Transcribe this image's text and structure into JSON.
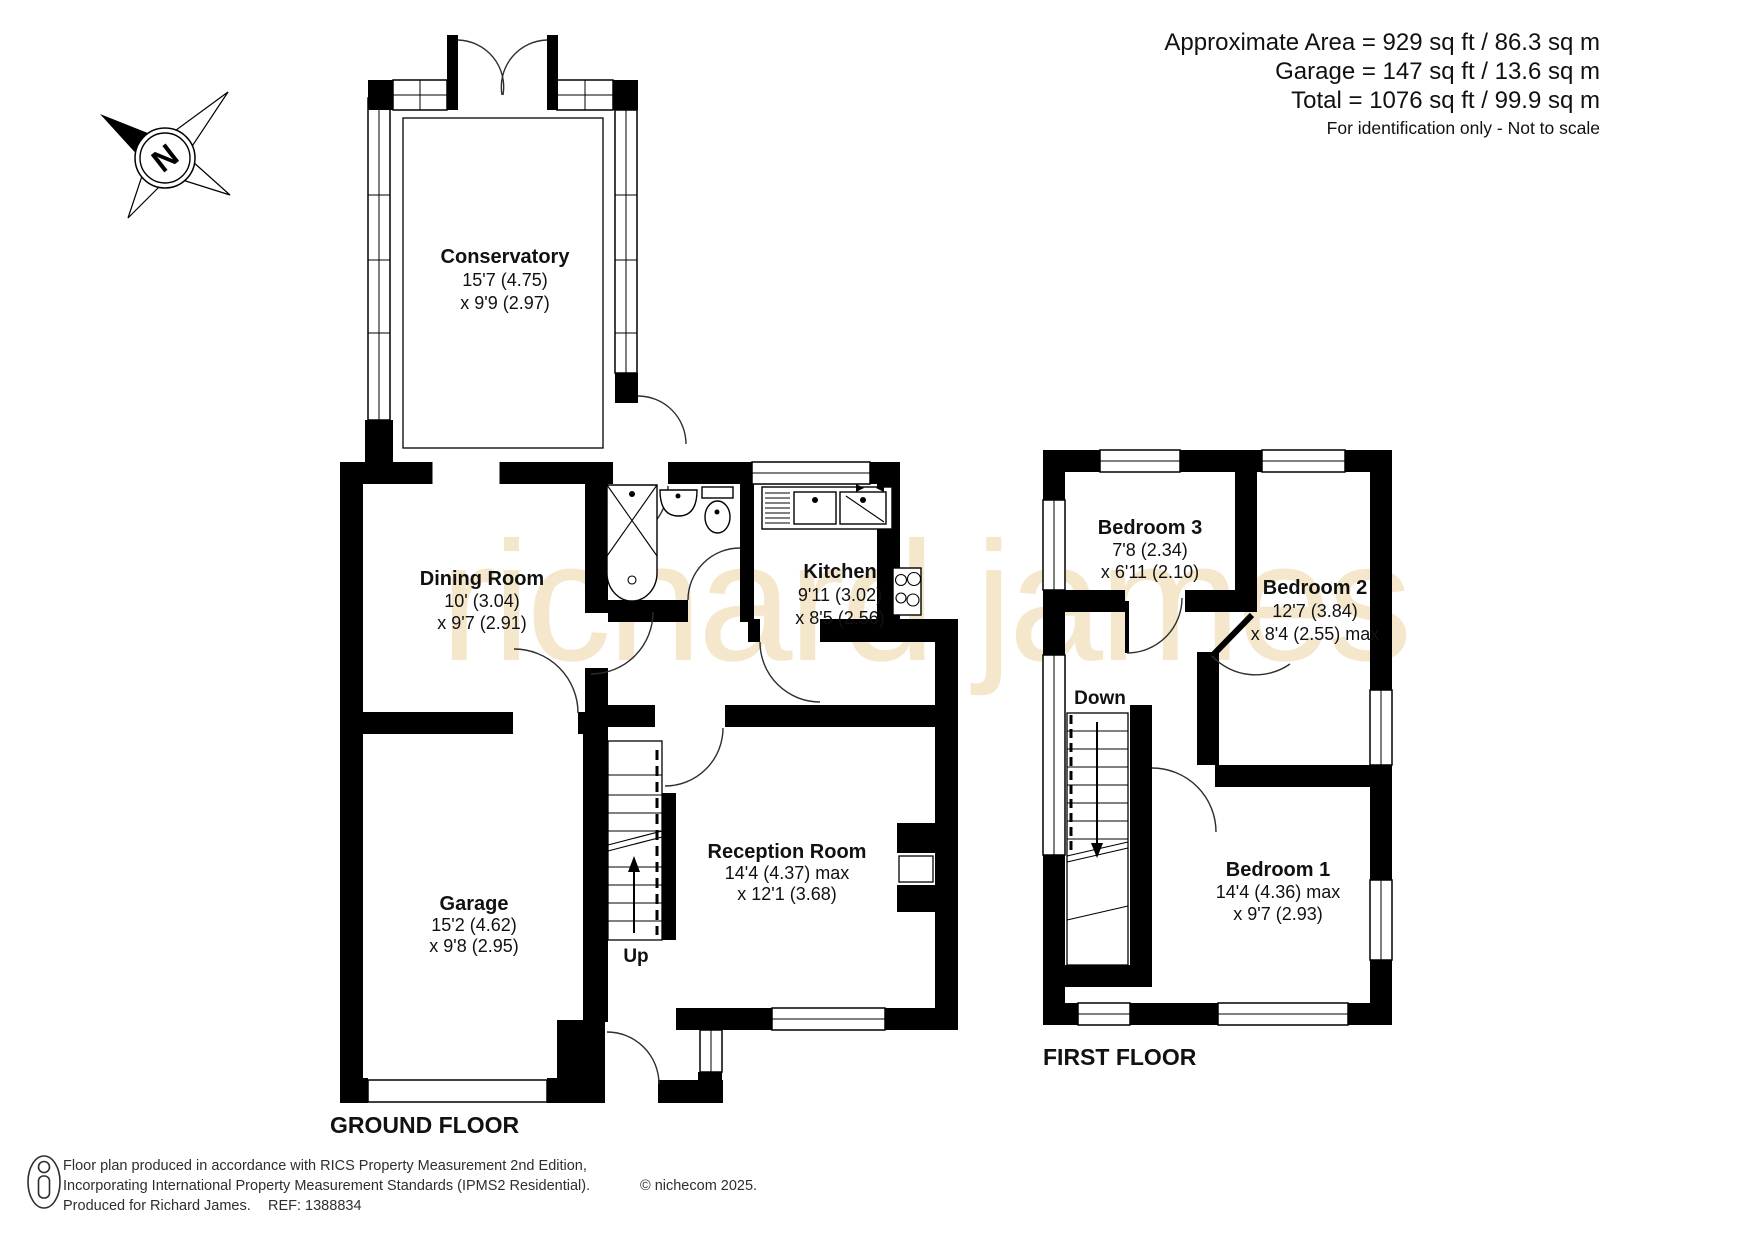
{
  "header": {
    "area_line": "Approximate Area = 929 sq ft / 86.3 sq m",
    "garage_line": "Garage = 147 sq ft / 13.6 sq m",
    "total_line": "Total = 1076 sq ft / 99.9 sq m",
    "note": "For identification only - Not to scale"
  },
  "watermark": "richard james",
  "compass": {
    "north_label": "N"
  },
  "ground_floor": {
    "title": "GROUND FLOOR",
    "stairs_label": "Up",
    "rooms": {
      "conservatory": {
        "name": "Conservatory",
        "dim1": "15'7 (4.75)",
        "dim2": "x 9'9 (2.97)"
      },
      "dining_room": {
        "name": "Dining Room",
        "dim1": "10' (3.04)",
        "dim2": "x 9'7 (2.91)"
      },
      "kitchen": {
        "name": "Kitchen",
        "dim1": "9'11 (3.02)",
        "dim2": "x 8'5 (2.56)"
      },
      "garage": {
        "name": "Garage",
        "dim1": "15'2 (4.62)",
        "dim2": "x 9'8 (2.95)"
      },
      "reception_room": {
        "name": "Reception Room",
        "dim1": "14'4 (4.37) max",
        "dim2": "x 12'1 (3.68)"
      }
    }
  },
  "first_floor": {
    "title": "FIRST FLOOR",
    "stairs_label": "Down",
    "rooms": {
      "bedroom_1": {
        "name": "Bedroom 1",
        "dim1": "14'4 (4.36) max",
        "dim2": "x 9'7 (2.93)"
      },
      "bedroom_2": {
        "name": "Bedroom 2",
        "dim1": "12'7 (3.84)",
        "dim2": "x 8'4 (2.55) max"
      },
      "bedroom_3": {
        "name": "Bedroom 3",
        "dim1": "7'8 (2.34)",
        "dim2": "x 6'11 (2.10)"
      }
    }
  },
  "footer": {
    "line1": "Floor plan produced in accordance with RICS Property Measurement 2nd Edition,",
    "line2": "Incorporating International Property Measurement Standards (IPMS2 Residential).",
    "copyright": "© nichecom 2025.",
    "produced": "Produced for Richard James.",
    "ref": "REF:  1388834"
  }
}
